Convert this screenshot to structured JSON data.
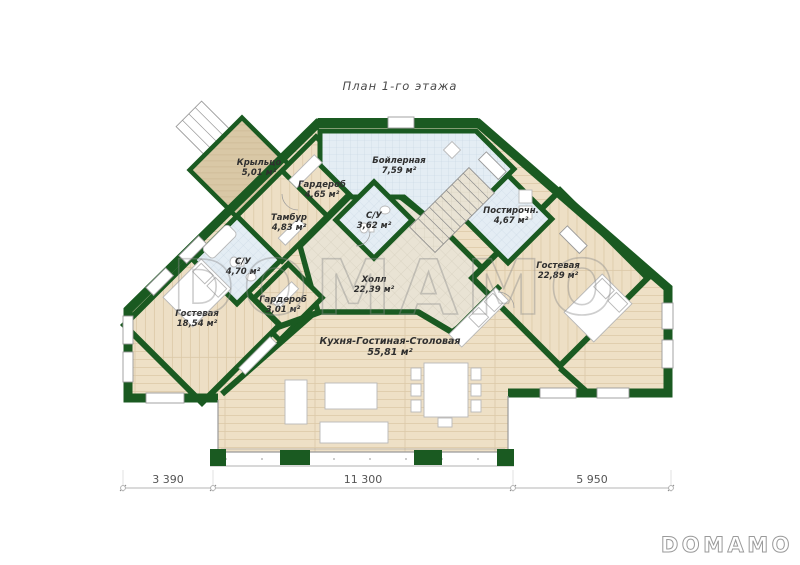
{
  "title": "План 1-го этажа",
  "plan": {
    "rooms": [
      {
        "id": "krylco",
        "name": "Крыльцо",
        "area": "5,01 м²"
      },
      {
        "id": "garderob-465",
        "name": "Гардероб",
        "area": "4,65 м²"
      },
      {
        "id": "boilernaya",
        "name": "Бойлерная",
        "area": "7,59 м²"
      },
      {
        "id": "tambur",
        "name": "Тамбур",
        "area": "4,83 м²"
      },
      {
        "id": "su-362",
        "name": "С/У",
        "area": "3,62 м²"
      },
      {
        "id": "postirochnaya",
        "name": "Постирочн.",
        "area": "4,67 м²"
      },
      {
        "id": "su-470",
        "name": "С/У",
        "area": "4,70 м²"
      },
      {
        "id": "gostevaya-2289",
        "name": "Гостевая",
        "area": "22,89 м²"
      },
      {
        "id": "garderob-301",
        "name": "Гардероб",
        "area": "3,01 м²"
      },
      {
        "id": "gostevaya-1854",
        "name": "Гостевая",
        "area": "18,54 м²"
      },
      {
        "id": "holl",
        "name": "Холл",
        "area": "22,39 м²"
      },
      {
        "id": "kitchen",
        "name": "Кухня-Гостиная-Столовая",
        "area": "55,81 м²"
      }
    ],
    "dimensions": {
      "segments": [
        "3 390",
        "11 300",
        "5 950"
      ]
    }
  },
  "watermark": {
    "center": "DOMAMO",
    "corner": "DOMAMO"
  },
  "colors": {
    "wall": "#1a5a21",
    "wood": "#eee0c6",
    "tile_blue": "#e4edf4",
    "tile_hall": "#e9e3d4",
    "deck": "#d9c8a6"
  }
}
